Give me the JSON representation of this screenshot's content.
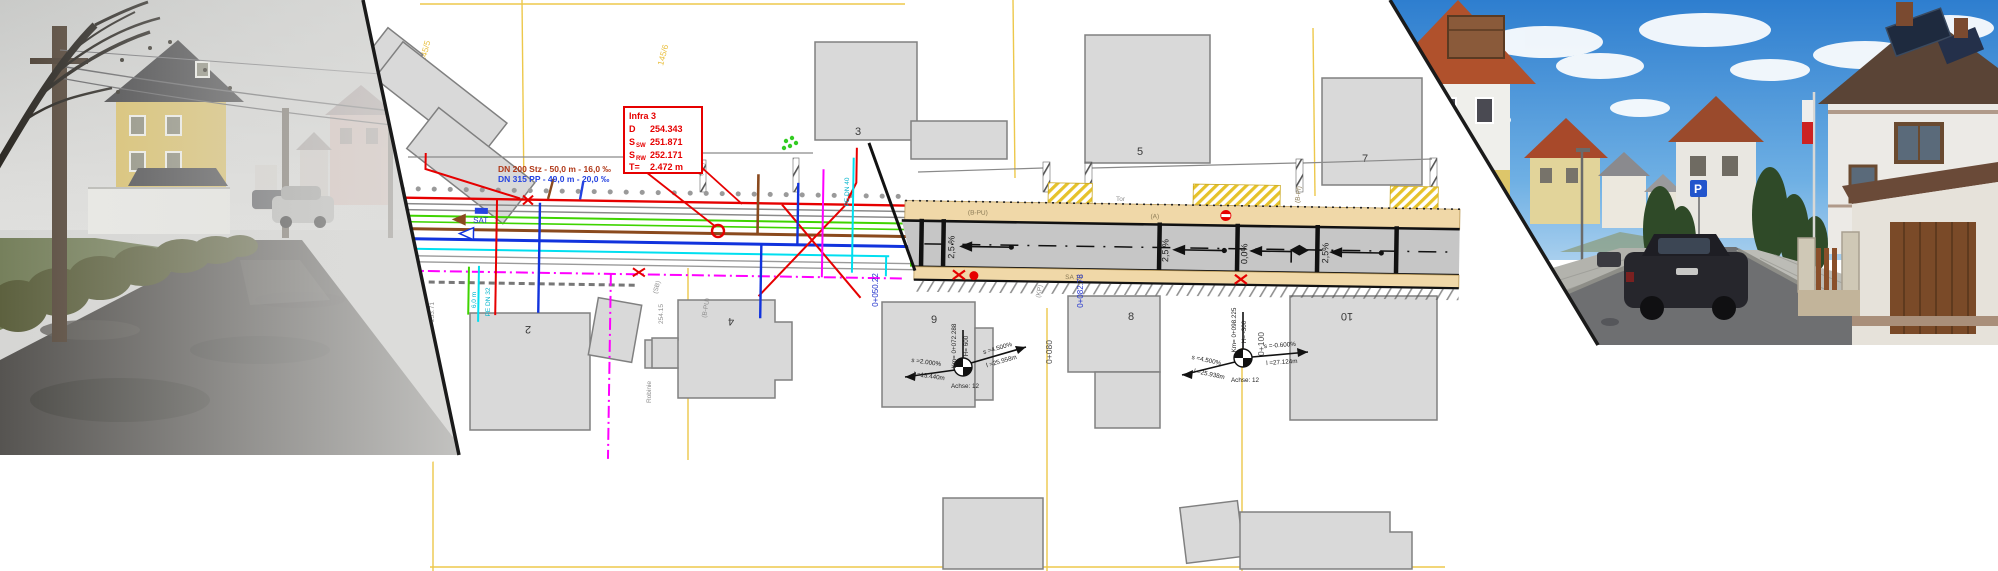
{
  "plan": {
    "infra": {
      "title": "Infra 3",
      "rows": [
        {
          "label": "D",
          "sub": "",
          "value": "254.343"
        },
        {
          "label": "S",
          "sub": "SW",
          "value": "251.871"
        },
        {
          "label": "S",
          "sub": "RW",
          "value": "252.171"
        },
        {
          "label": "T=",
          "sub": "",
          "value": "2.472 m"
        }
      ]
    },
    "pipes": {
      "sewer": "DN 200 Stz - 50,0 m - 16,0 ‰",
      "storm": "DN 315 PP - 49,0 m - 20,0 ‰"
    },
    "buildings": [
      "2",
      "3",
      "4",
      "5",
      "7",
      "8",
      "9",
      "10"
    ],
    "parcels": [
      "145/5",
      "145/6",
      "145/15",
      "146/14"
    ],
    "slopes": [
      "2,5 %",
      "2,5 %",
      "0,0%",
      "2,5%"
    ],
    "stations_black": [
      "0+080",
      "0+100"
    ],
    "stations_blue": [
      "0+050.22",
      "0+082.78"
    ],
    "gradients": {
      "left": {
        "km": "Km= 0+072.288",
        "h": "H= 600",
        "left_s": "s =2.000%",
        "left_l": "l =15.440m",
        "right_s": "s =4.500%",
        "right_l": "l =25.958m",
        "axis": "Achse: 12"
      },
      "right": {
        "km": "Km= 0+098.225",
        "h": "H= -300",
        "left_s": "s =4.500%",
        "left_l": "l =25.938m",
        "right_s": "s =-0.600%",
        "right_l": "l =27.124m",
        "axis": "Achse: 12"
      }
    },
    "surface": {
      "bpu": "(B-PU)",
      "a": "(A)",
      "sa10": "SA 10",
      "bpf": "(B-Pf)"
    },
    "small": {
      "kp": "(KP)",
      "sb": "(SB)",
      "tor": "Tor",
      "robinie": "Robinie",
      "sat": "SAT",
      "pedn32": "PE DN 32",
      "pedn40": "PE DN 40",
      "len6": "6,0 m",
      "h254": "254.15",
      "h253": "253.71",
      "bpu_rot": "(B-PU)"
    }
  },
  "colors": {
    "utility_red": "#e60000",
    "utility_green": "#3fd400",
    "utility_brown": "#8a4a1e",
    "utility_blue": "#1133dd",
    "utility_cyan": "#00dff0",
    "utility_magenta": "#ff00ff",
    "parcel_yellow": "#edc84b",
    "building_fill": "#d9d9d9",
    "sidewalk_beige": "#f0d8a8",
    "road_gray": "#c6c6c6"
  }
}
